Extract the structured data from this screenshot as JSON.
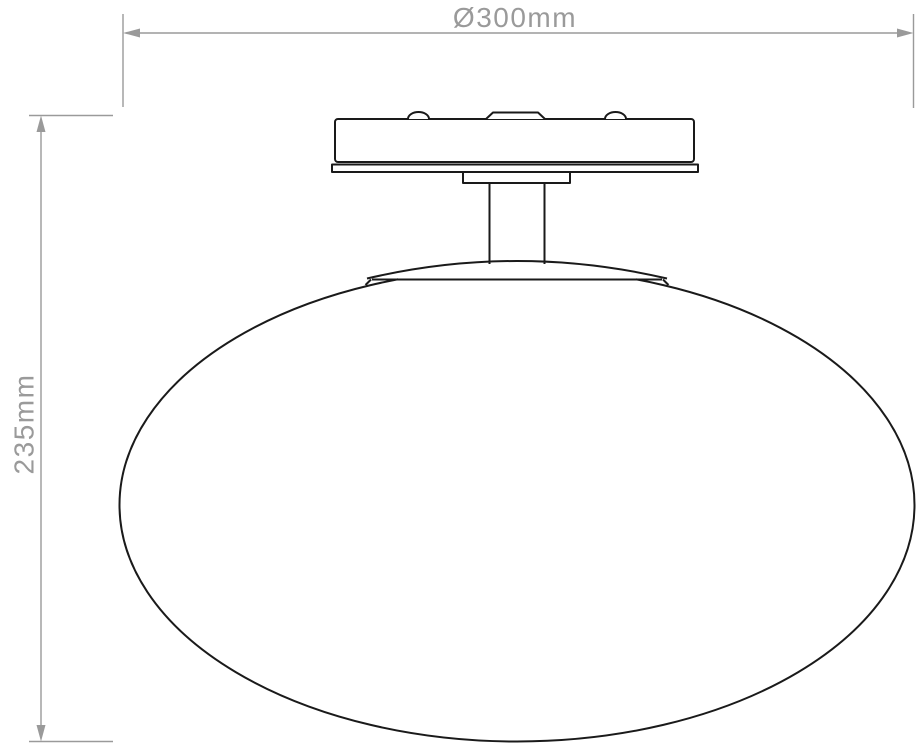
{
  "diagram": {
    "description": "Technical dimension drawing of a semi-flush ceiling light with an oval glass globe and ceiling mounting plate",
    "dimension_width": {
      "label": "Ø300mm"
    },
    "dimension_height": {
      "label": "235mm"
    },
    "colors": {
      "line": "#1a1a1a",
      "dimension": "#9a9a9a",
      "background": "#ffffff"
    }
  }
}
